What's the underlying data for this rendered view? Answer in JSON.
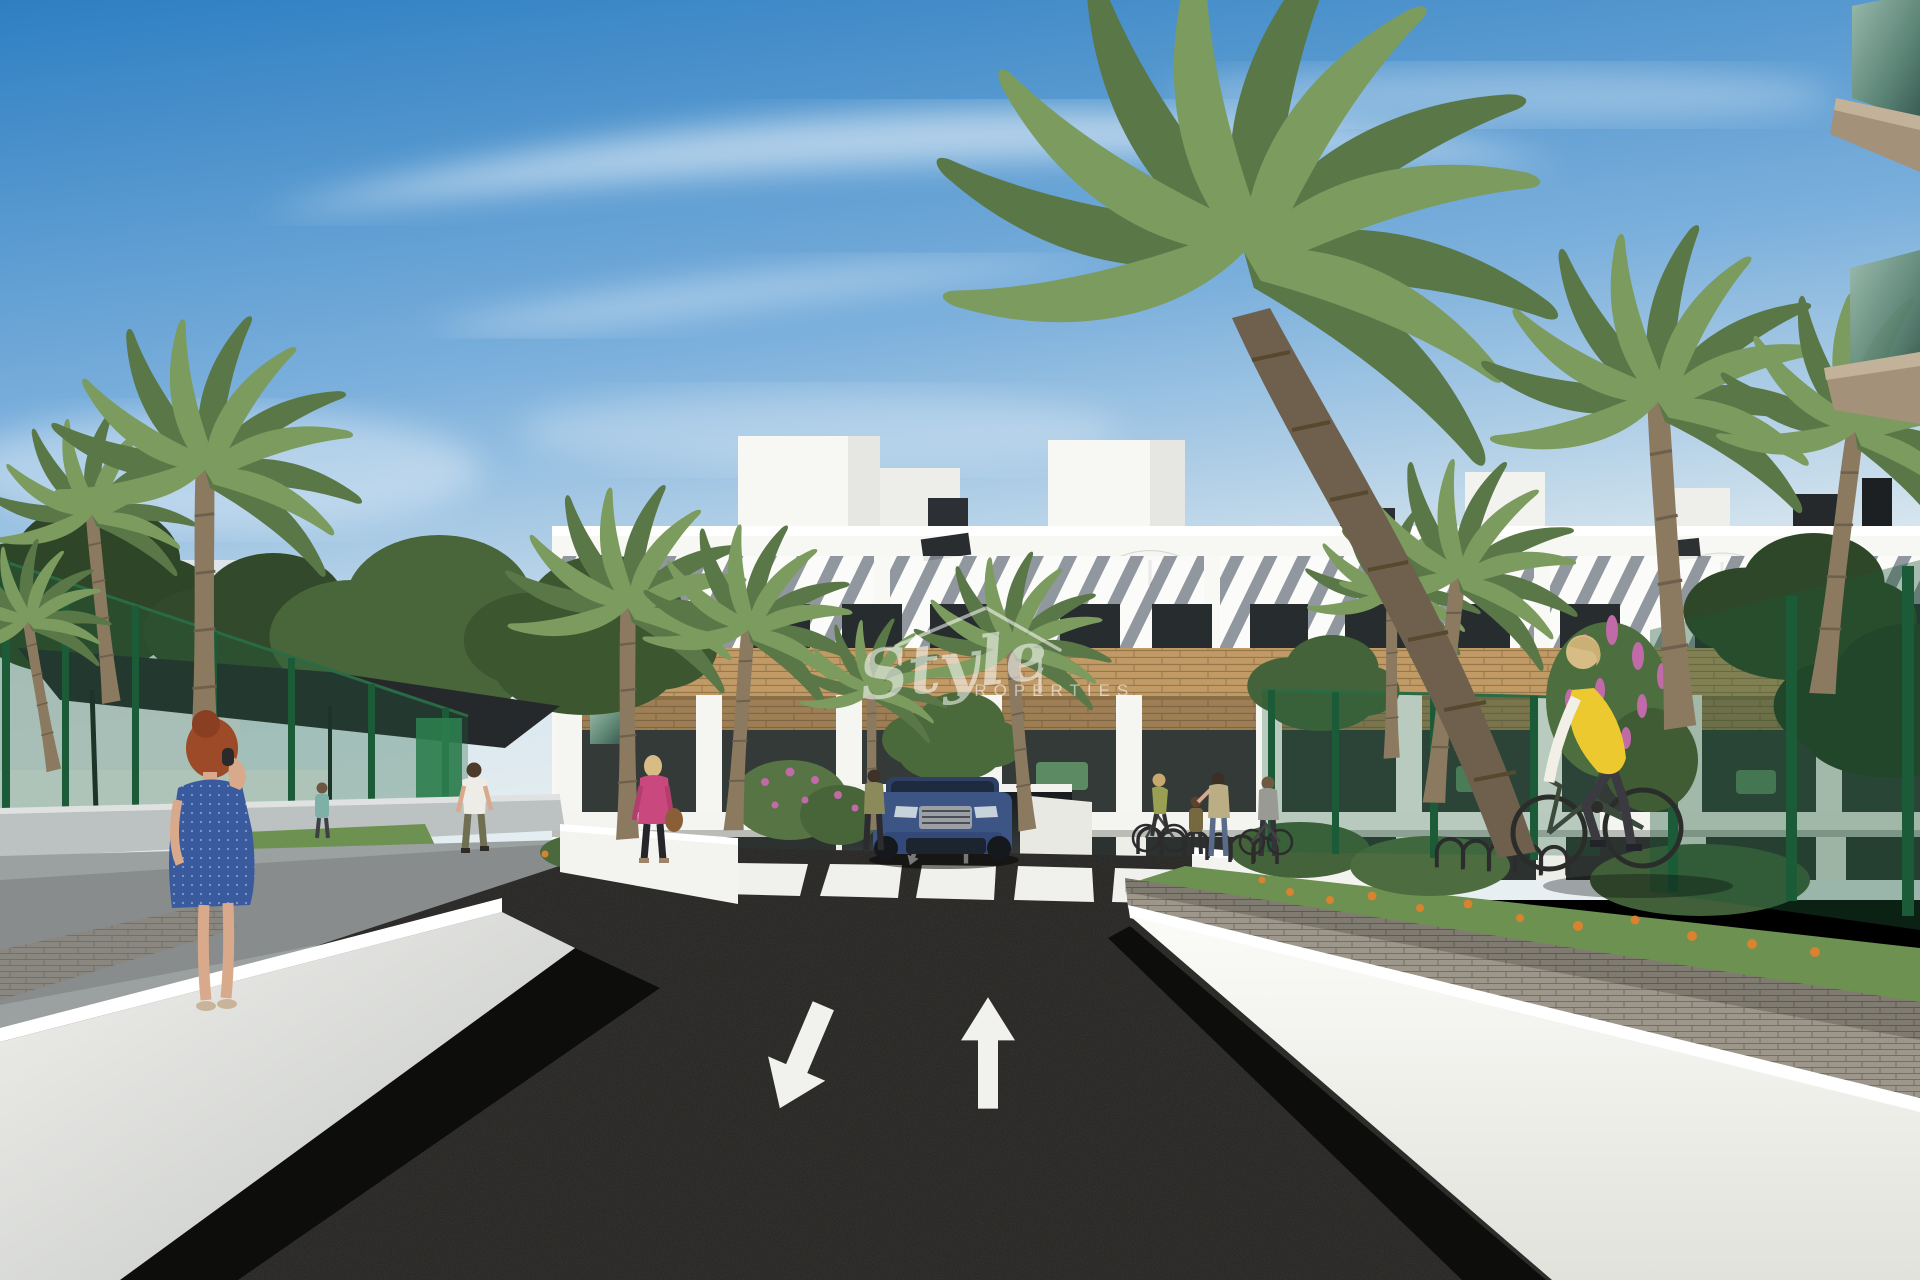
{
  "watermark": {
    "line1": "Style",
    "line2": "PROPERTIES",
    "icon": "house-outline-icon",
    "color": "#ffffff",
    "opacity": 0.55
  },
  "road_markings": {
    "arrows": [
      "down-left",
      "up"
    ],
    "crosswalk_stripes": 5,
    "paint_color": "#f1f1ee"
  },
  "colors": {
    "sky_top": "#2e7fc2",
    "sky_mid": "#7cb0dc",
    "sky_horizon": "#dbe8ef",
    "building": "#f7f7f4",
    "building_shade": "#e3e4df",
    "window_dark": "#272c2f",
    "slat_shadow": "#868c94",
    "wood": "#c19a65",
    "wood_dark": "#97784c",
    "fence_green": "#1c5b38",
    "gate_green": "#2e7d4f",
    "canopy_dark": "#26292b",
    "road_asphalt": "#22211f",
    "path_gray": "#9ba0a1",
    "wall_lit": "#f3f3ef",
    "wall_top": "#ffffff",
    "grass": "#6d9150",
    "flower_orange": "#d9822f",
    "flower_pink": "#c06aa8",
    "car_blue": "#3c5584",
    "dress_blue": "#3a5a9e",
    "jacket_pink": "#c9497f",
    "vest_yellow": "#ecc92f",
    "hair_red": "#9c4a28",
    "skin": "#d8a98b"
  }
}
